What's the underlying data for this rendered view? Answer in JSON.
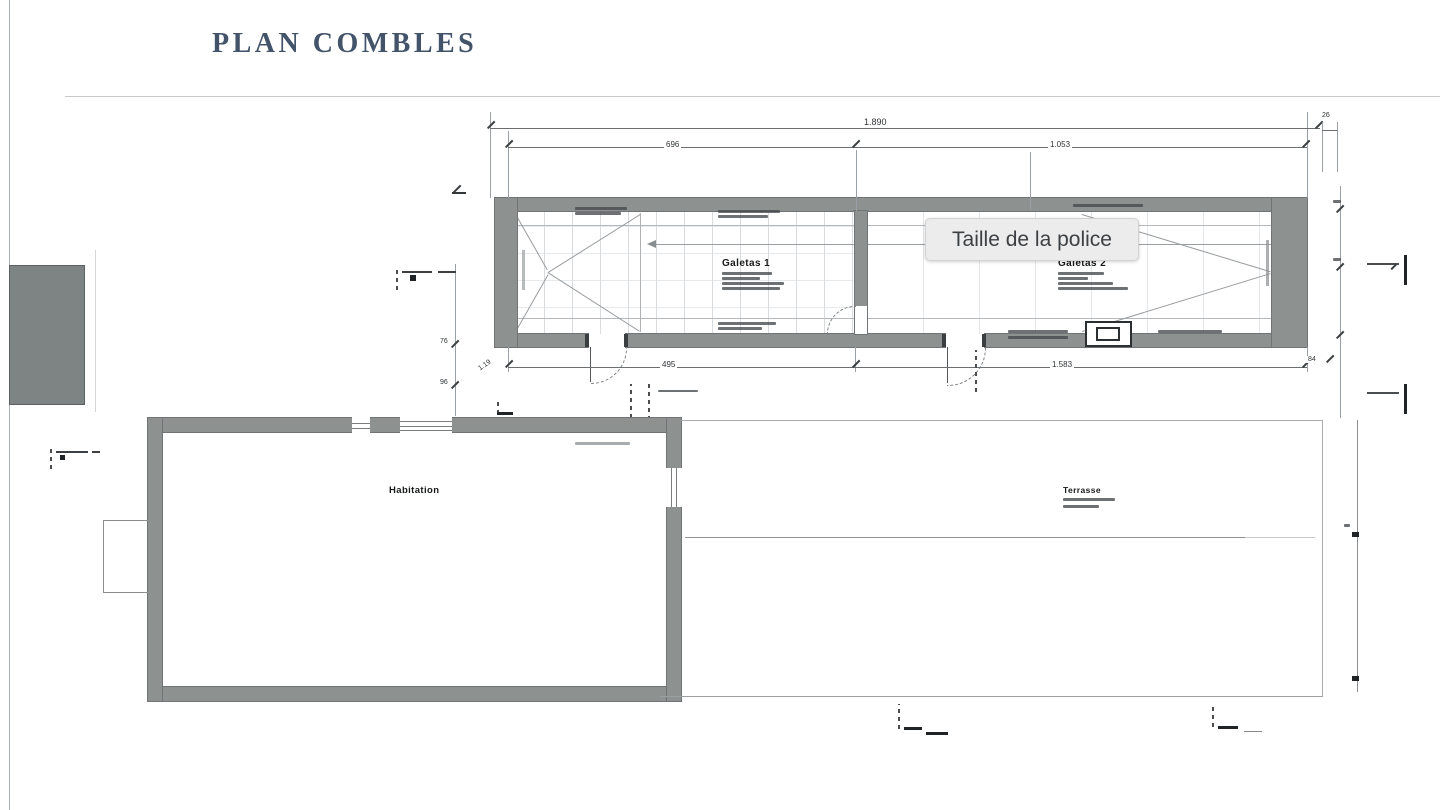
{
  "header": {
    "title": "PLAN COMBLES"
  },
  "tooltip": {
    "text": "Taille de la police"
  },
  "rooms": {
    "galetas1": {
      "name": "Galetas 1"
    },
    "galetas2": {
      "name": "Galetas 2"
    },
    "habitation": {
      "name": "Habitation"
    },
    "terrasse": {
      "name": "Terrasse"
    }
  },
  "dimensions": {
    "top_total": "1.890",
    "top_left_span": "696",
    "top_right_span": "1.053",
    "mid_left_span": "495",
    "mid_right_span": "1.583",
    "left_tick_upper": "76",
    "left_tick_lower": "96",
    "left_slanted": "1.19",
    "top_right_mini": "26",
    "right_lower": "84"
  }
}
